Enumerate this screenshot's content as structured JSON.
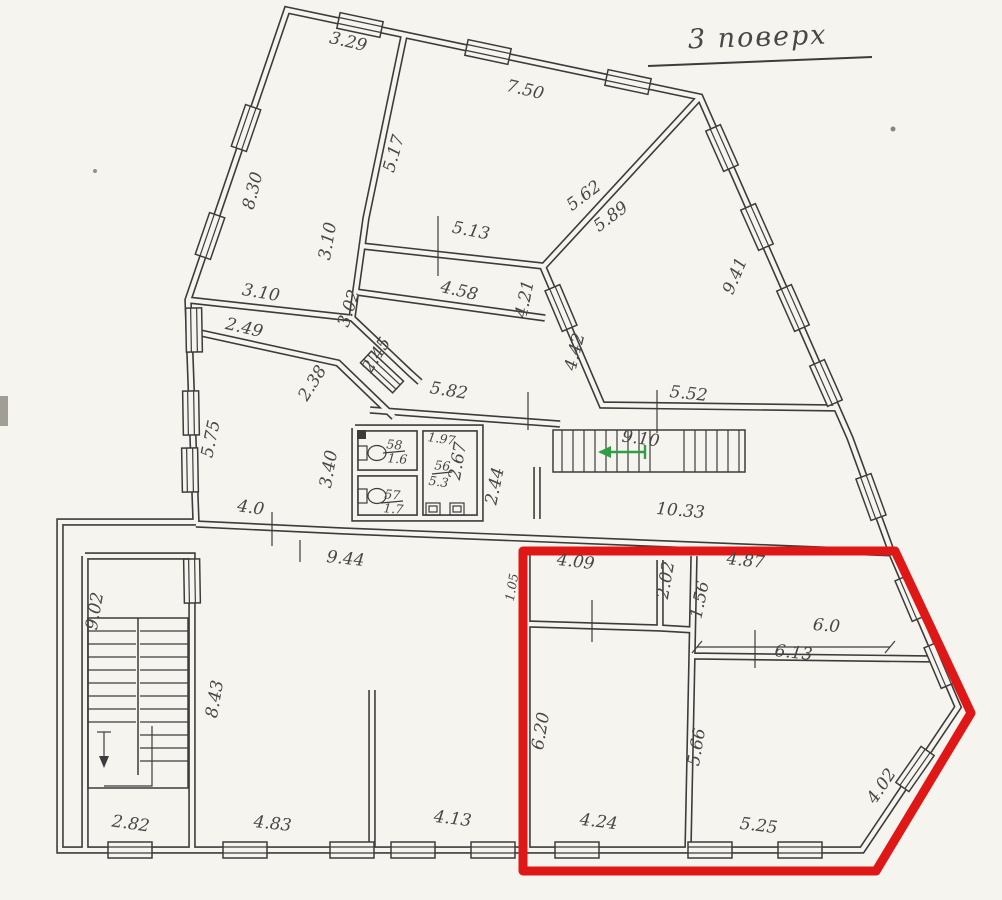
{
  "title": {
    "text": "3 поверх"
  },
  "colors": {
    "paper": "#f6f4ef",
    "ink": "#3c3c3c",
    "label": "#474747",
    "highlight_red": "#e01717",
    "arrow_green": "#2f9e44"
  },
  "highlight": {
    "shape": "red-outline-around-bottom-right-section"
  },
  "labels": [
    {
      "t": "3.29"
    },
    {
      "t": "7.50"
    },
    {
      "t": "8.30"
    },
    {
      "t": "5.17"
    },
    {
      "t": "3.10"
    },
    {
      "t": "3.10"
    },
    {
      "t": "2.49"
    },
    {
      "t": "3.02"
    },
    {
      "t": "2.45"
    },
    {
      "t": "2.38"
    },
    {
      "t": "5.13"
    },
    {
      "t": "4.58"
    },
    {
      "t": "4.21"
    },
    {
      "t": "5.62"
    },
    {
      "t": "5.89"
    },
    {
      "t": "4.42"
    },
    {
      "t": "9.41"
    },
    {
      "t": "5.82"
    },
    {
      "t": "5.52"
    },
    {
      "t": "3.40"
    },
    {
      "t": "5.75"
    },
    {
      "t": "4.0"
    },
    {
      "t": "1.97"
    },
    {
      "t": "2.67"
    },
    {
      "t": "2.44"
    },
    {
      "t": "9.10"
    },
    {
      "t": "10.33"
    },
    {
      "t": "9.44"
    },
    {
      "t": "9.02"
    },
    {
      "t": "8.43"
    },
    {
      "t": "2.82"
    },
    {
      "t": "4.83"
    },
    {
      "t": "4.13"
    },
    {
      "t": "1.05"
    },
    {
      "t": "4.09"
    },
    {
      "t": "2.02"
    },
    {
      "t": "1.56"
    },
    {
      "t": "4.87"
    },
    {
      "t": "6.0"
    },
    {
      "t": "6.13"
    },
    {
      "t": "6.20"
    },
    {
      "t": "5.66"
    },
    {
      "t": "4.24"
    },
    {
      "t": "5.25"
    },
    {
      "t": "4.02"
    },
    {
      "t": "58"
    },
    {
      "t": "1.6"
    },
    {
      "t": "57"
    },
    {
      "t": "1.7"
    },
    {
      "t": "56"
    },
    {
      "t": "5.3"
    }
  ]
}
